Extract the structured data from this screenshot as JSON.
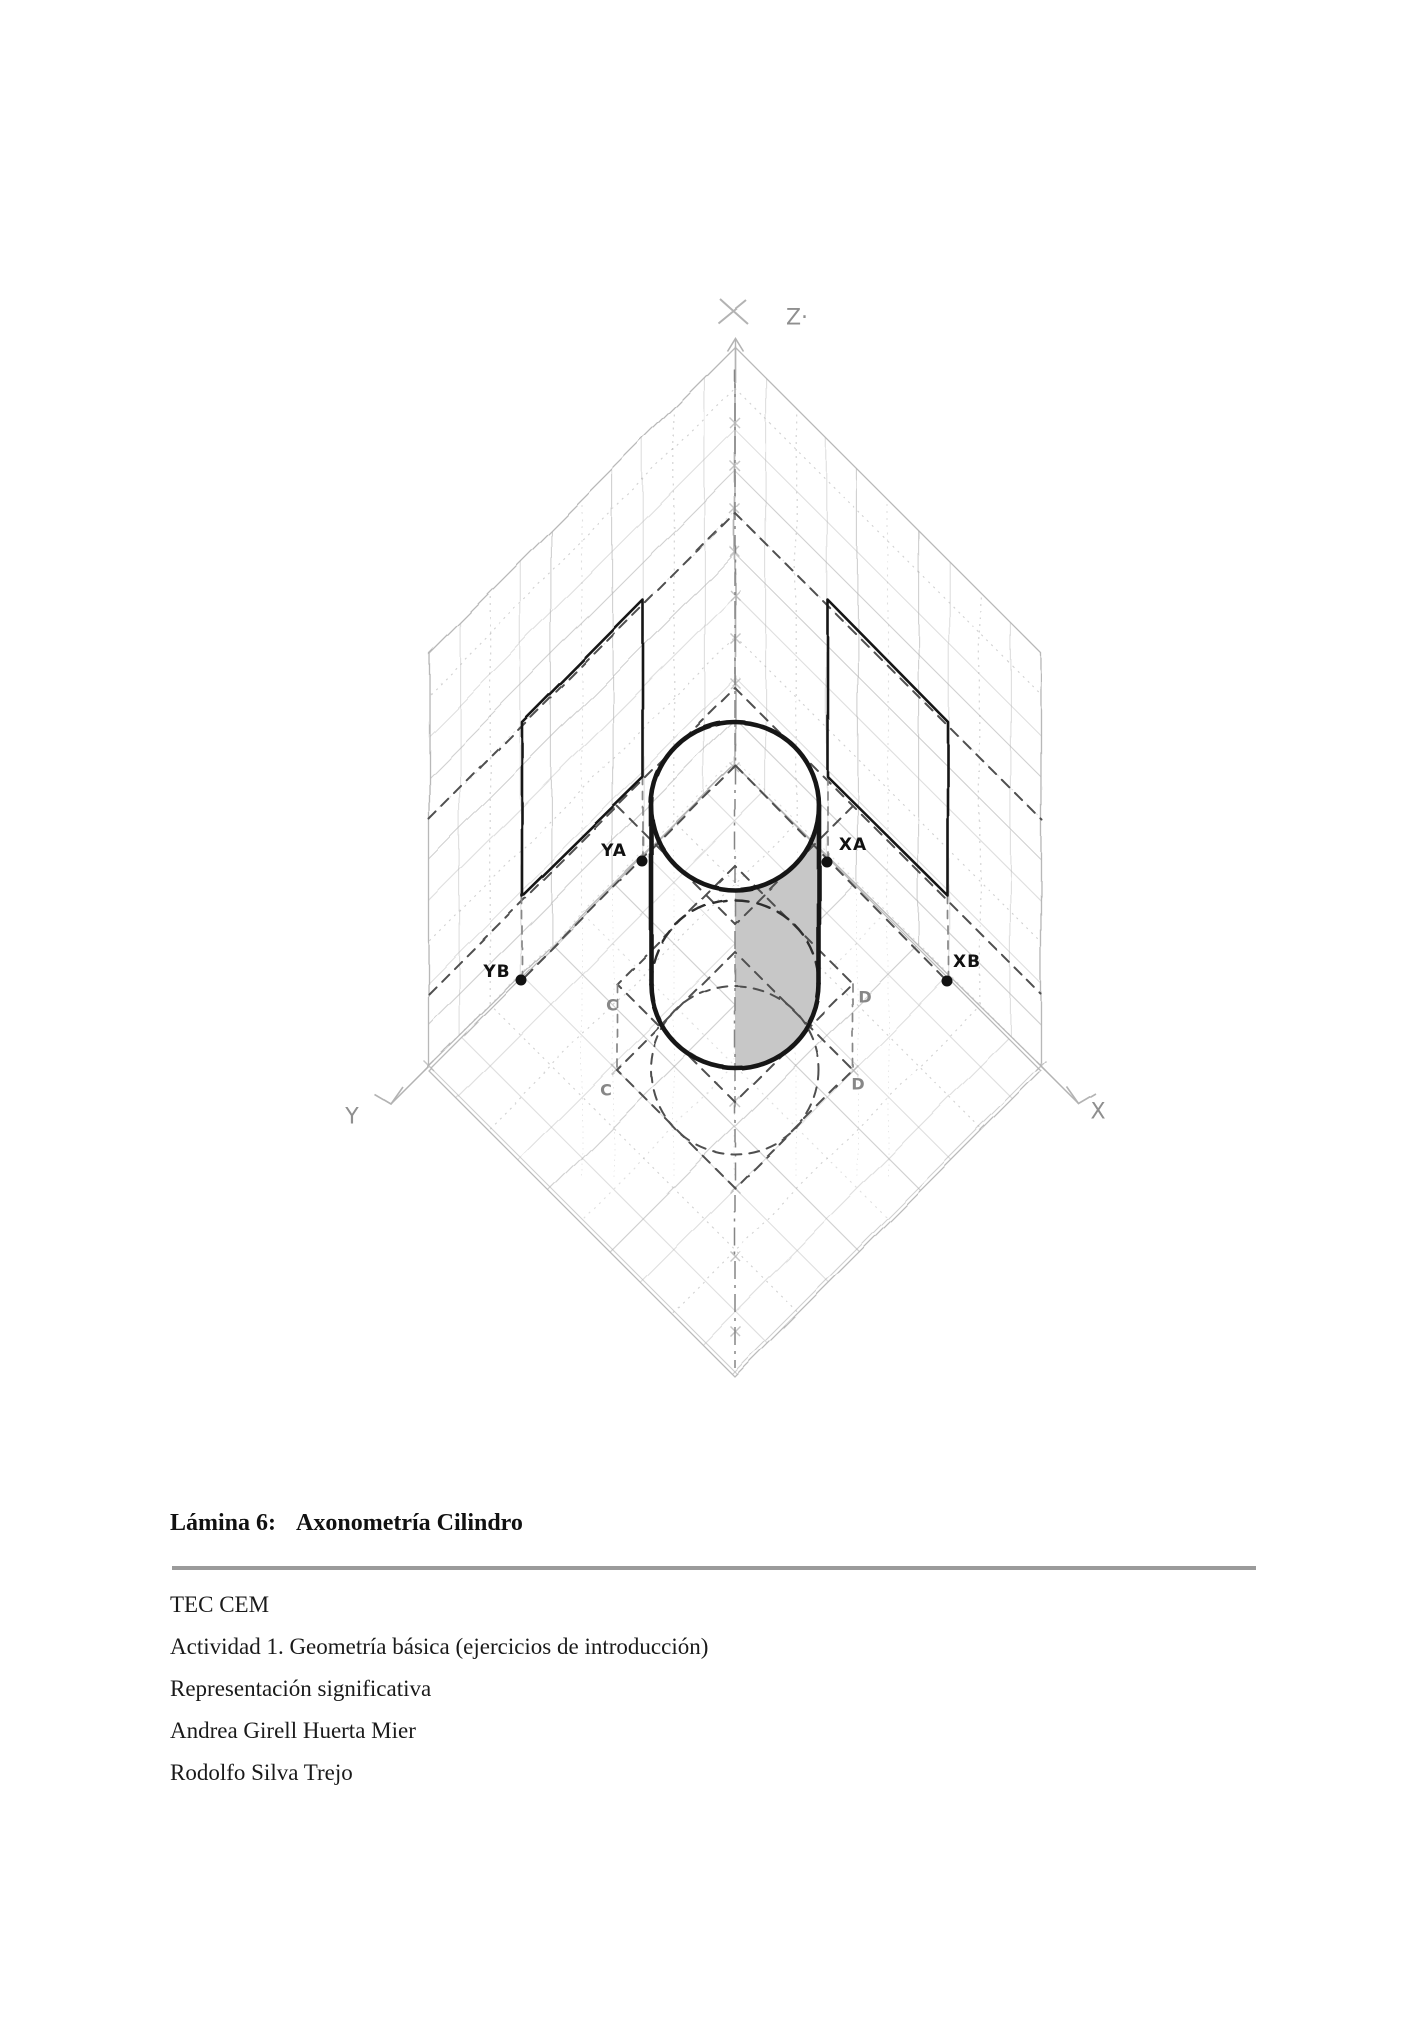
{
  "figure": {
    "axis_labels": {
      "z": "Z·",
      "y": "Y",
      "x": "X"
    },
    "points": {
      "ya": "YA",
      "xa": "XA",
      "yb": "YB",
      "xb": "XB"
    },
    "construction_labels": {
      "c_upper": "C",
      "c_lower": "C",
      "d_upper": "D",
      "d_lower": "D"
    },
    "colors": {
      "pencil": "#b3b3b3",
      "dash": "#4f4f4f",
      "dashlight": "#878787",
      "ink": "#161616",
      "shade": "#c7c7c7",
      "label_ink": "#111111",
      "label_pencil": "#8f8f8f"
    }
  },
  "caption": {
    "label": "Lámina 6:",
    "title": "Axonometría Cilindro"
  },
  "footer": {
    "lines": [
      "TEC CEM",
      "Actividad 1. Geometría básica (ejercicios de introducción)",
      "Representación significativa",
      "Andrea Girell Huerta Mier",
      "Rodolfo Silva Trejo"
    ]
  }
}
